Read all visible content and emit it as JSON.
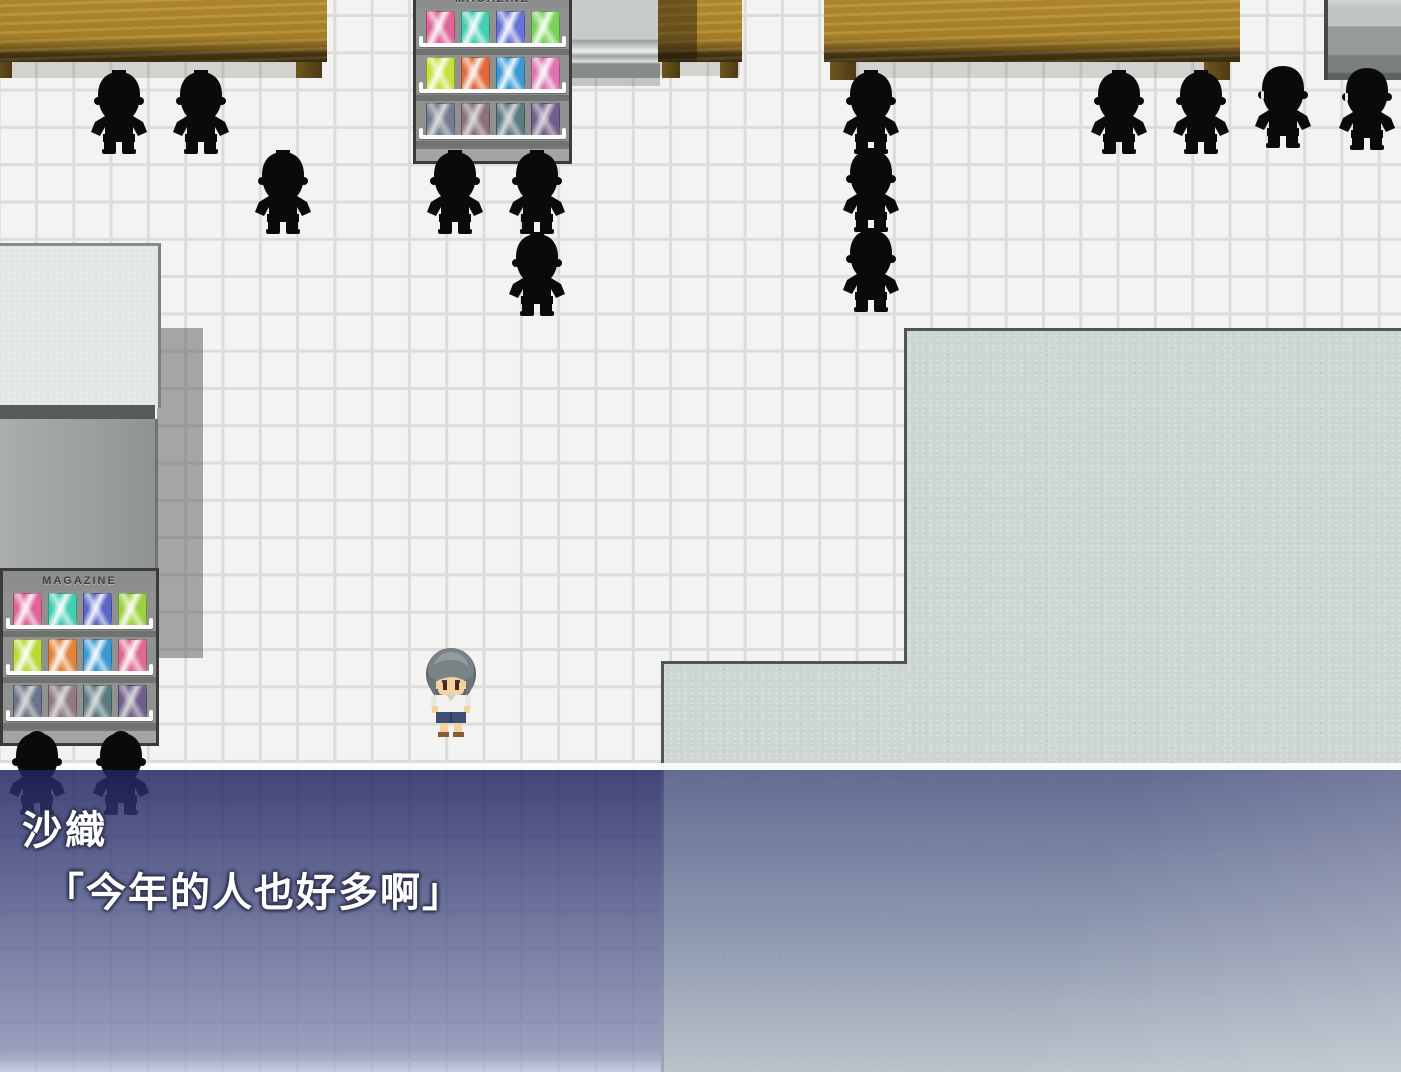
{
  "window": {
    "speaker": "沙織",
    "line": "「今年的人也好多啊」"
  },
  "labels": {
    "magazine": "MAGAZINE"
  },
  "palette": {
    "floor": "#f3f3f2",
    "grid_line": "#dcdcda",
    "platform": "#ced6d2",
    "platform_edge": "#4f5654",
    "table_wood": "#b2892e",
    "silhouette": "#0a0a0a",
    "window_navy_top": "#42467a",
    "window_fade_bottom": "#9aa0bd",
    "dialog_text": "#ffffff",
    "rack_body": "#989b99"
  },
  "racks": [
    {
      "x": 413,
      "y": -14,
      "rows": [
        [
          "#e0639a",
          "#45cdb2",
          "#6673d6",
          "#79d157"
        ],
        [
          "#c6e03a",
          "#e06a39",
          "#3a99d4",
          "#de74b2"
        ],
        [
          "#7a90b6",
          "#b27a90",
          "#4f929c",
          "#8a64c2"
        ]
      ]
    },
    {
      "x": 0,
      "y": 568,
      "rows": [
        [
          "#e0639a",
          "#45cdb2",
          "#5a66c8",
          "#9ad13e"
        ],
        [
          "#b8d936",
          "#e08439",
          "#3a99d4",
          "#e06a8e"
        ],
        [
          "#6f86b2",
          "#b2869a",
          "#4f929c",
          "#8a64c2"
        ]
      ]
    }
  ],
  "figures": [
    {
      "x": 88,
      "y": 70,
      "v": "front"
    },
    {
      "x": 170,
      "y": 70,
      "v": "front"
    },
    {
      "x": 252,
      "y": 150,
      "v": "front"
    },
    {
      "x": 424,
      "y": 150,
      "v": "front"
    },
    {
      "x": 506,
      "y": 150,
      "v": "front"
    },
    {
      "x": 506,
      "y": 232,
      "v": "front"
    },
    {
      "x": 840,
      "y": 70,
      "v": "front"
    },
    {
      "x": 840,
      "y": 148,
      "v": "front"
    },
    {
      "x": 840,
      "y": 228,
      "v": "front"
    },
    {
      "x": 1088,
      "y": 70,
      "v": "front"
    },
    {
      "x": 1170,
      "y": 70,
      "v": "front"
    },
    {
      "x": 1252,
      "y": 64,
      "v": "side"
    },
    {
      "x": 1336,
      "y": 66,
      "v": "side"
    },
    {
      "x": 6,
      "y": 731,
      "v": "bun"
    },
    {
      "x": 90,
      "y": 731,
      "v": "bun"
    }
  ],
  "player": {
    "x": 419,
    "y": 646
  }
}
